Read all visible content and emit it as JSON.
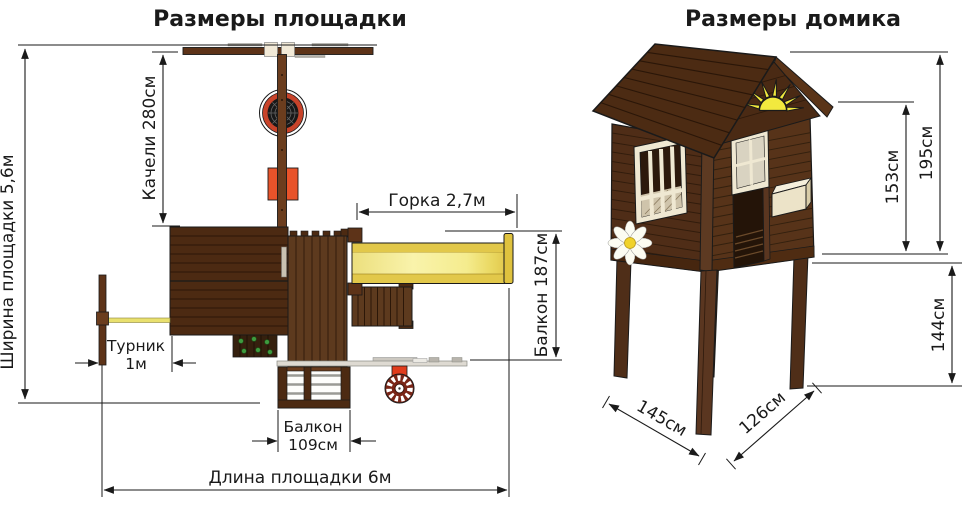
{
  "playground": {
    "title": "Размеры площадки",
    "dim_width": "Ширина площадки 5,6м",
    "dim_swing": "Качели 280см",
    "dim_slide": "Горка 2,7м",
    "dim_balcony_side": "Балкон 187см",
    "dim_bar_name": "Турник",
    "dim_bar_value": "1м",
    "dim_balcony_front_name": "Балкон",
    "dim_balcony_front_value": "109см",
    "dim_length": "Длина площадки 6м"
  },
  "house": {
    "title": "Размеры домика",
    "dim_total_height": "195см",
    "dim_wall_height": "153см",
    "dim_legs_height": "144см",
    "dim_depth": "145см",
    "dim_width": "126см"
  },
  "colors": {
    "background": "#ffffff",
    "wood_dark": "#4a2a12",
    "wood_medium": "#5d3a1e",
    "slide_yellow": "#f8f2a2",
    "slide_gold": "#e2c84a",
    "nest_swing_red": "#c8432a",
    "seat_orange": "#e8532a",
    "holds_green": "#3f9b3f",
    "sun_yellow": "#f2e93e",
    "trim_cream": "#efe8d2",
    "dimension_ink": "#1a1a1a"
  }
}
